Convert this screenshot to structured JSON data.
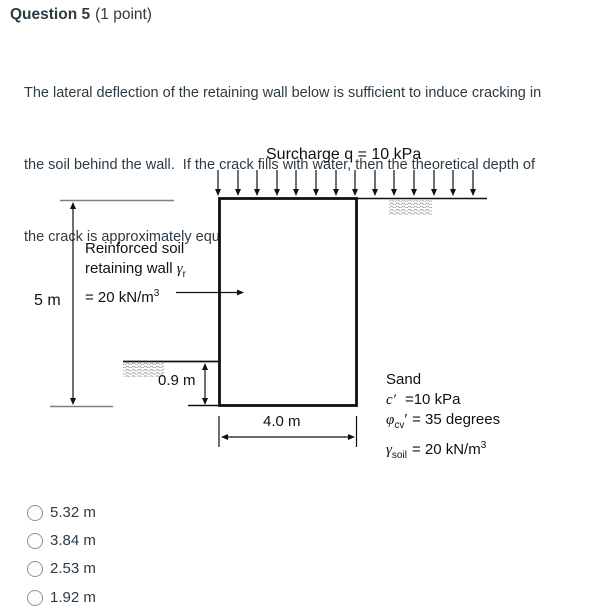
{
  "header": {
    "title": "Question 5",
    "points": "(1 point)"
  },
  "question": {
    "lines": [
      "The lateral deflection of the retaining wall below is sufficient to induce cracking in",
      "the soil behind the wall.  If the crack fills with water, then the theoretical depth of",
      "the crack is approximately equal to:"
    ]
  },
  "diagram": {
    "surcharge_label": "Surcharge q = 10 kPa",
    "wall_height_label": "5 m",
    "embedment_label": "0.9 m",
    "base_width_label": "4.0 m",
    "wall_label": {
      "line1": "Reinforced soil",
      "line2_text": "retaining wall ",
      "line2_gamma": "γ",
      "line2_sub": "r",
      "line3_text": "= 20 kN/m",
      "line3_sup": "3"
    },
    "sand": {
      "title": "Sand",
      "c_symbol": "c′",
      "c_value": "=10 kPa",
      "phi_symbol": "φ",
      "phi_sub": "cv",
      "phi_prime": "′",
      "phi_value": "= 35 degrees",
      "gamma_symbol": "γ",
      "gamma_sub": "soil",
      "gamma_value": "= 20 kN/m",
      "gamma_sup": "3"
    },
    "colors": {
      "line": "#111111",
      "grey_line": "#808080",
      "hatch": "#8f8f8f"
    }
  },
  "options": [
    {
      "label": "5.32 m"
    },
    {
      "label": "3.84 m"
    },
    {
      "label": "2.53 m"
    },
    {
      "label": "1.92 m"
    }
  ]
}
